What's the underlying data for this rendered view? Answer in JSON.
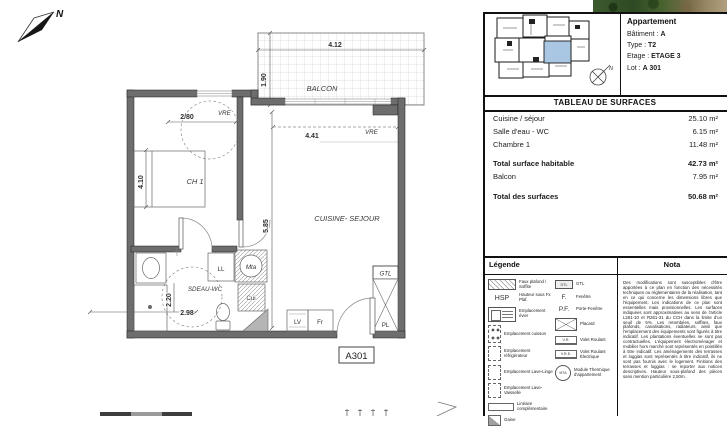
{
  "plan": {
    "north": "N",
    "labels": {
      "balcon": "BALCON",
      "ch1": "CH 1",
      "cuisine_sejour": "CUISINE- SEJOUR",
      "sdeau_wc": "SDEAU-WC",
      "vre_sejour": "VRE",
      "vre_ch1": "VRE",
      "ll": "LL",
      "mta": "Mta",
      "cui": "Cui",
      "lv": "LV",
      "fr": "Fr",
      "gtl": "GTL",
      "pl": "PL",
      "lot": "A301"
    },
    "dimensions": {
      "balcon_w": "4.12",
      "balcon_d": "1.90",
      "sejour_w": "4.41",
      "ch1_window": "2/80",
      "ch1_d": "4.10",
      "sejour_d": "5.85",
      "sdb_w": "2.98",
      "sdb_d": "2.20"
    }
  },
  "panel": {
    "apartment": {
      "title": "Appartement",
      "fields": [
        {
          "label": "Bâtiment :",
          "value": "A"
        },
        {
          "label": "Type :",
          "value": "T2"
        },
        {
          "label": "Etage :",
          "value": "ETAGE 3"
        },
        {
          "label": "Lot :",
          "value": "A 301"
        }
      ]
    },
    "surface_table": {
      "title": "TABLEAU DE SURFACES",
      "rows": [
        {
          "label": "Cuisine / séjour",
          "value": "25.10 m²"
        },
        {
          "label": "Salle d'eau - WC",
          "value": "6.15 m²"
        },
        {
          "label": "Chambre 1",
          "value": "11.48 m²"
        },
        {
          "label": "Total surface habitable",
          "value": "42.73 m²"
        },
        {
          "label": "Balcon",
          "value": "7.95 m²"
        },
        {
          "label": "Total des surfaces",
          "value": "50.68 m²"
        }
      ]
    },
    "legend": {
      "title": "Légende",
      "icon_texts": {
        "hsp": "HSP",
        "gtl": "GTL",
        "f": "F.",
        "pf": "P.F.",
        "vr": "V.R.",
        "vre": "V.R.E.",
        "mta": "MTA"
      },
      "left": [
        {
          "icon": "ceiling-hatch",
          "label": "Faux plafond / Soffite"
        },
        {
          "icon": "hsp",
          "label": "Hauteur sous Fx Plaf."
        },
        {
          "icon": "sink",
          "label": "Emplacement évier"
        },
        {
          "icon": "cooktop",
          "label": "Emplacement cuisson"
        },
        {
          "icon": "fridge",
          "label": "Emplacement réfrigérateur"
        },
        {
          "icon": "washer",
          "label": "Emplacement Lave-Linge"
        },
        {
          "icon": "dishwasher",
          "label": "Emplacement Lave-Vaisselle"
        },
        {
          "icon": "linear",
          "label": "Linéaire complémentaire"
        },
        {
          "icon": "duct",
          "label": "Gaine"
        }
      ],
      "right": [
        {
          "icon": "gtl",
          "label": "GTL"
        },
        {
          "icon": "window",
          "label": "Fenêtre"
        },
        {
          "icon": "french-window",
          "label": "Porte-Fenêtre"
        },
        {
          "icon": "closet",
          "label": "Placard"
        },
        {
          "icon": "roller-shutter",
          "label": "Volet Roulant"
        },
        {
          "icon": "electric-roller-shutter",
          "label": "Volet Roulant Électrique"
        },
        {
          "icon": "mta",
          "label": "Module Thermique d'appartement"
        }
      ]
    },
    "nota": {
      "title": "Nota",
      "text": "Des modifications sont susceptibles d'être apportées à ce plan en fonction des nécessités techniques ou réglementaires de la réalisation, tant en ce qui concerne les dimensions libres que l'équipement. Les indications de ce plan sont essentielles mais provisionnelles. Les surfaces indiquées sont approximatives au sens de l'article L261-10 et R261-31 du CCH dans la limite d'un seuil de 5%. Les retombées, soffites, faux plafonds, canalisations, radiateurs, ainsi que l'emplacement des équipements sont figurés à titre indicatif. Les plantations éventuelles ne sont pas contractuelles. L'équipement électroménager et mobilier hors marché sont représentés en pointillés à titre indicatif. Les aménagements des terrasses et loggias sont représentés à titre indicatif, ils ne sont pas fournis avec le logement. Finitions des terrasses et loggias : se reporter aux notices descriptives. Hauteur sous-plafond des pièces sans mention particulière 2,50m."
    }
  }
}
